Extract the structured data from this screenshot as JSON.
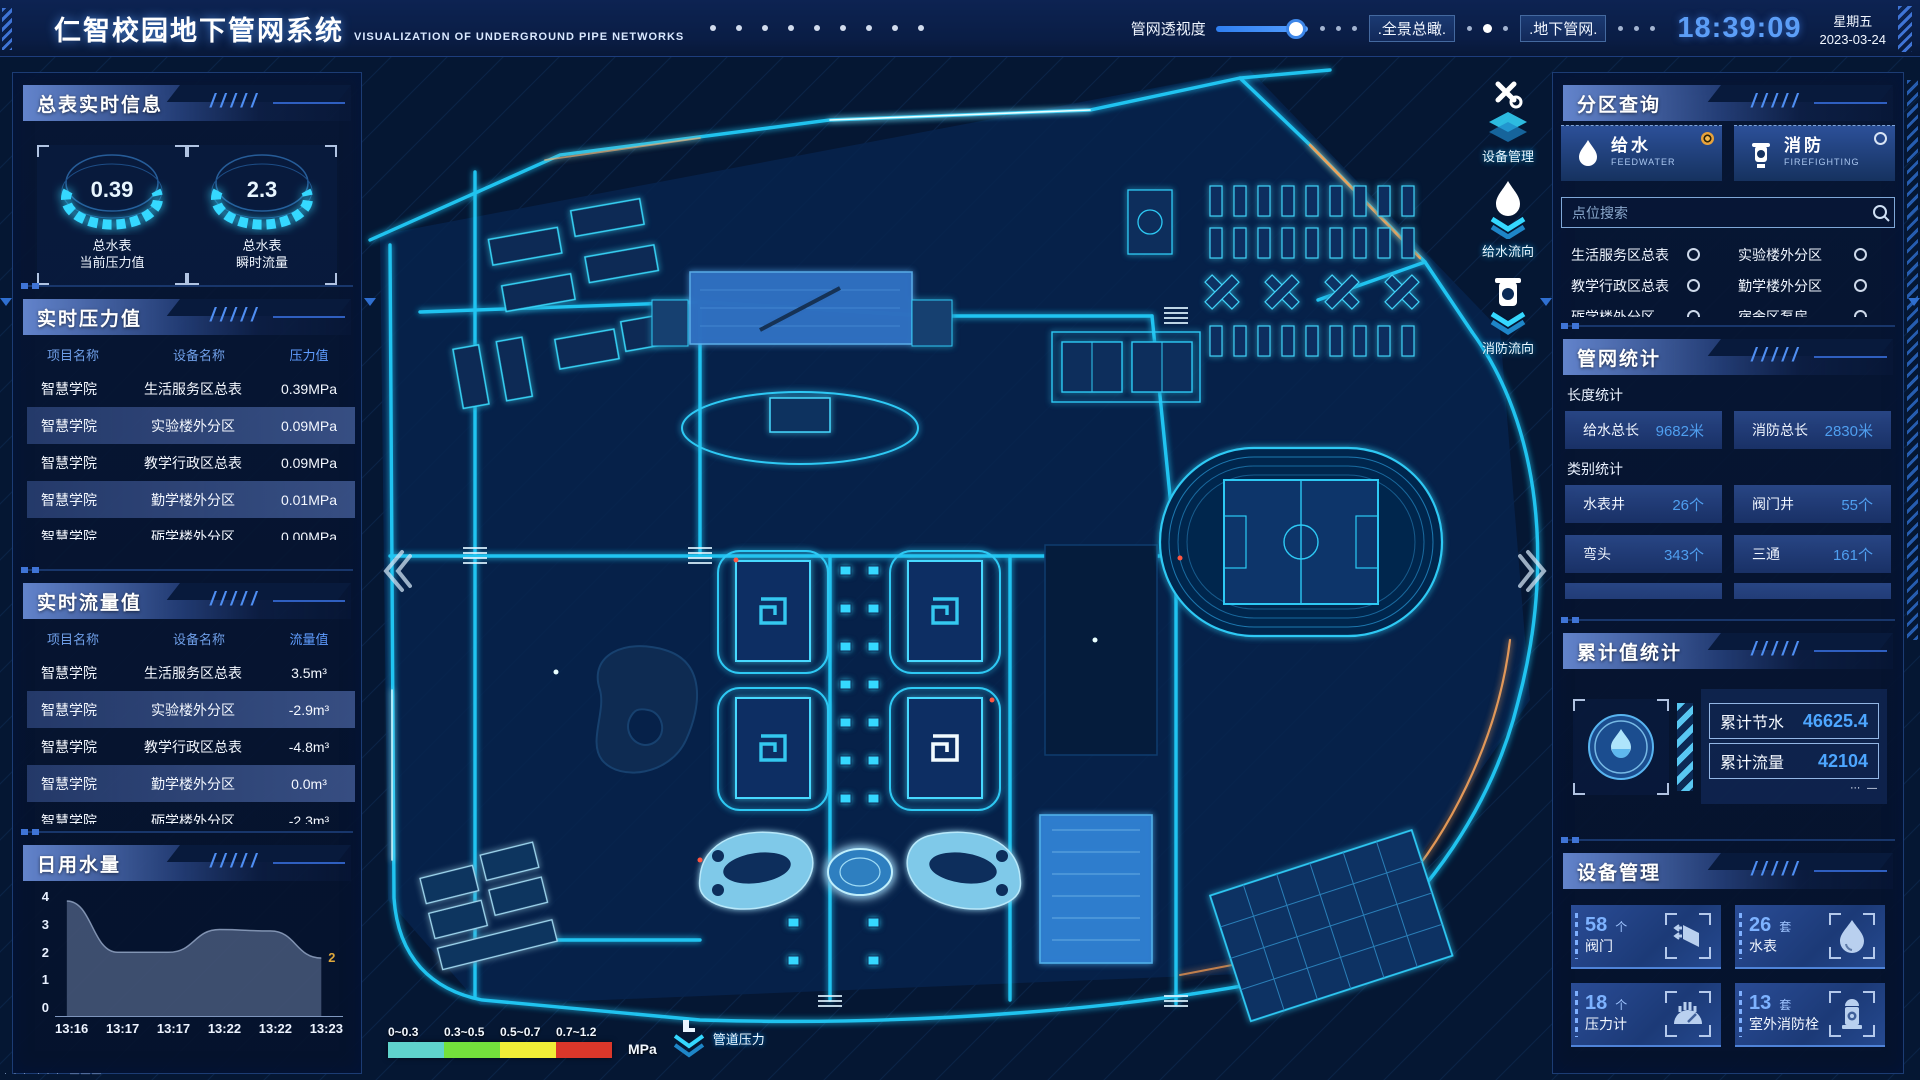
{
  "header": {
    "title": "仁智校园地下管网系统",
    "subtitle": "VISUALIZATION OF UNDERGROUND PIPE NETWORKS",
    "slider_label": "管网透视度",
    "btn_overview": ".全景总瞰.",
    "btn_underground": ".地下管网.",
    "clock": "18:39:09",
    "weekday": "星期五",
    "date": "2023-03-24"
  },
  "master_meter": {
    "title": "总表实时信息",
    "gauges": [
      {
        "value": "0.39",
        "label1": "总水表",
        "label2": "当前压力值"
      },
      {
        "value": "2.3",
        "label1": "总水表",
        "label2": "瞬时流量"
      }
    ]
  },
  "pressure": {
    "title": "实时压力值",
    "columns": [
      "项目名称",
      "设备名称",
      "压力值"
    ],
    "rows": [
      [
        "智慧学院",
        "生活服务区总表",
        "0.39MPa"
      ],
      [
        "智慧学院",
        "实验楼外分区",
        "0.09MPa"
      ],
      [
        "智慧学院",
        "教学行政区总表",
        "0.09MPa"
      ],
      [
        "智慧学院",
        "勤学楼外分区",
        "0.01MPa"
      ],
      [
        "智慧学院",
        "砺学楼外分区",
        "0.00MPa"
      ]
    ]
  },
  "flow": {
    "title": "实时流量值",
    "columns": [
      "项目名称",
      "设备名称",
      "流量值"
    ],
    "rows": [
      [
        "智慧学院",
        "生活服务区总表",
        "3.5m³"
      ],
      [
        "智慧学院",
        "实验楼外分区",
        "-2.9m³"
      ],
      [
        "智慧学院",
        "教学行政区总表",
        "-4.8m³"
      ],
      [
        "智慧学院",
        "勤学楼外分区",
        "0.0m³"
      ],
      [
        "智慧学院",
        "砺学楼外分区",
        "-2.3m³"
      ]
    ]
  },
  "chart_data": {
    "type": "area",
    "title": "日用水量",
    "x": [
      "13:16",
      "13:17",
      "13:17",
      "13:22",
      "13:22",
      "13:23"
    ],
    "values": [
      4,
      2.2,
      2.2,
      3.0,
      2.95,
      2.0
    ],
    "ylim": [
      0,
      4
    ],
    "yticks": [
      "4",
      "3",
      "2",
      "1",
      "0"
    ],
    "end_label": "2",
    "end_label_color": "#e0a93c",
    "area_color": "rgba(124,144,182,0.48)"
  },
  "zone_query": {
    "title": "分区查询",
    "tabs": [
      {
        "label": "给水",
        "sub": "FEEDWATER",
        "selected": true
      },
      {
        "label": "消防",
        "sub": "FIREFIGHTING",
        "selected": false
      }
    ],
    "search_placeholder": "点位搜索",
    "options": [
      "生活服务区总表",
      "实验楼外分区",
      "教学行政区总表",
      "勤学楼外分区",
      "砺学楼外分区",
      "宿舍区泵房"
    ]
  },
  "pipe_stats": {
    "title": "管网统计",
    "length_title": "长度统计",
    "length_items": [
      {
        "label": "给水总长",
        "value": "9682米"
      },
      {
        "label": "消防总长",
        "value": "2830米"
      }
    ],
    "category_title": "类别统计",
    "category_items": [
      {
        "label": "水表井",
        "value": "26个"
      },
      {
        "label": "阀门井",
        "value": "55个"
      },
      {
        "label": "弯头",
        "value": "343个"
      },
      {
        "label": "三通",
        "value": "161个"
      }
    ]
  },
  "cumulative": {
    "title": "累计值统计",
    "items": [
      {
        "label": "累计节水",
        "value": "46625.4"
      },
      {
        "label": "累计流量",
        "value": "42104"
      }
    ]
  },
  "devices": {
    "title": "设备管理",
    "cards": [
      {
        "count": "58",
        "unit": "个",
        "label": "阀门",
        "icon": "valve-icon"
      },
      {
        "count": "26",
        "unit": "套",
        "label": "水表",
        "icon": "water-meter-icon"
      },
      {
        "count": "18",
        "unit": "个",
        "label": "压力计",
        "icon": "pressure-gauge-icon"
      },
      {
        "count": "13",
        "unit": "套",
        "label": "室外消防栓",
        "icon": "hydrant-icon"
      }
    ]
  },
  "map_overlay": {
    "tools": [
      {
        "label": "设备管理",
        "icon": "wrench-icon"
      },
      {
        "label": "给水流向",
        "icon": "water-drop-icon"
      },
      {
        "label": "消防流向",
        "icon": "hydrant-icon"
      }
    ],
    "legend": {
      "ranges": [
        {
          "label": "0~0.3",
          "color": "#5fd3cc"
        },
        {
          "label": "0.3~0.5",
          "color": "#74e03c"
        },
        {
          "label": "0.5~0.7",
          "color": "#f1ee37"
        },
        {
          "label": "0.7~1.2",
          "color": "#da372a"
        }
      ],
      "unit": "MPa",
      "pipe_pressure_label": "管道压力"
    }
  },
  "colors": {
    "accent_cyan": "#2fd4fa",
    "accent_blue": "#4f9ff0",
    "clock_blue": "#5c9ef7",
    "panel_border": "#1c3c74",
    "selected_radio_orange": "#e8a23a"
  }
}
